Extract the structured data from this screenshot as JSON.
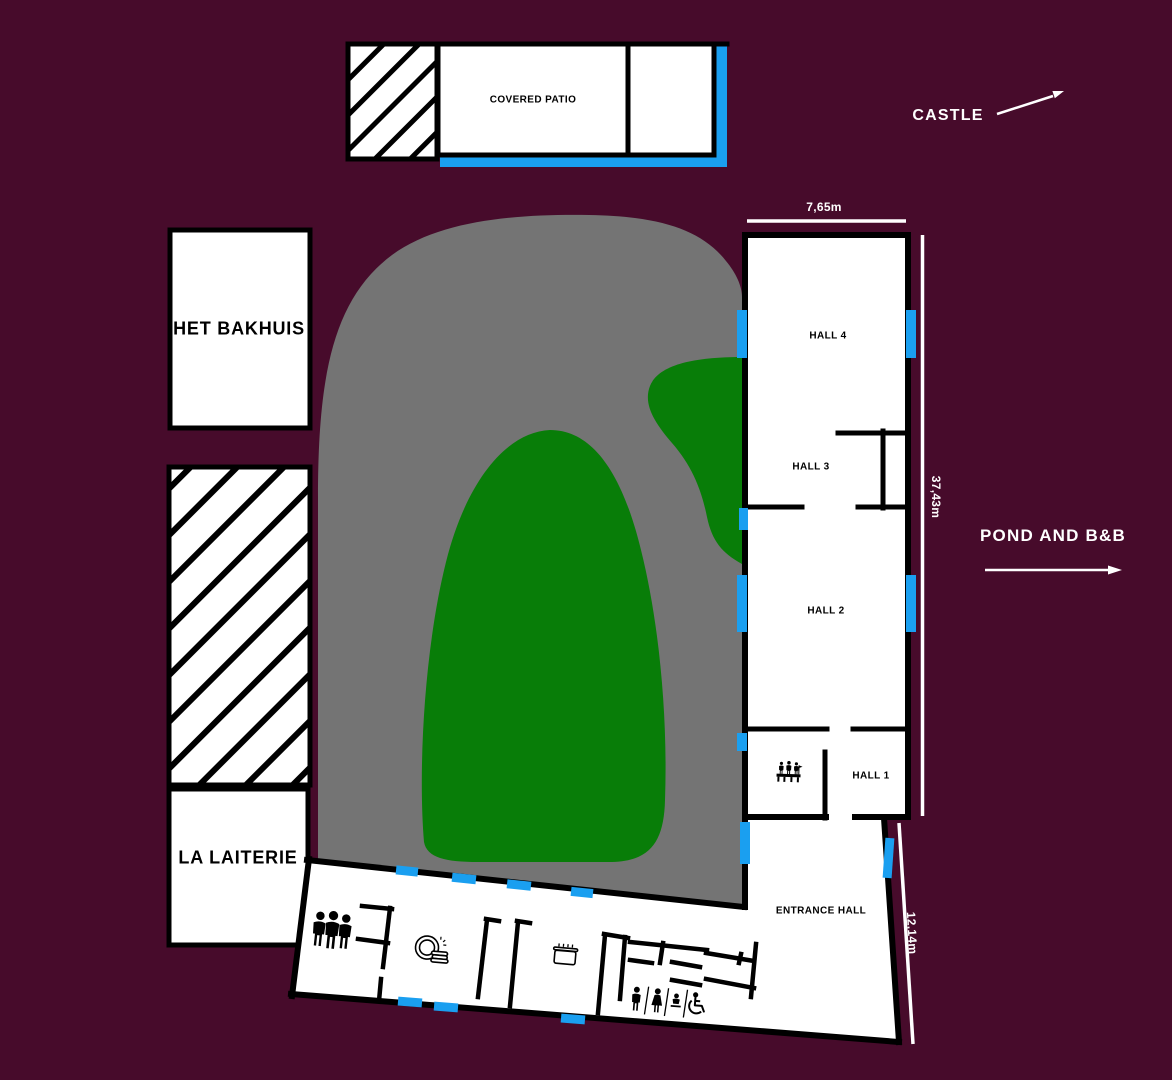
{
  "colors": {
    "background": "#470b2b",
    "courtyard": "#747474",
    "grass": "#087d08",
    "door": "#1a9ff0",
    "wall": "#000000",
    "room": "#ffffff",
    "label_light": "#ffffff"
  },
  "buildings": {
    "covered_patio": {
      "label": "COVERED PATIO"
    },
    "het_bakhuis": {
      "label": "HET BAKHUIS"
    },
    "la_laiterie": {
      "label": "LA LAITERIE"
    },
    "hall_4": {
      "label": "HALL 4"
    },
    "hall_3": {
      "label": "HALL 3"
    },
    "hall_2": {
      "label": "HALL 2"
    },
    "hall_1": {
      "label": "HALL 1"
    },
    "entrance_hall": {
      "label": "ENTRANCE HALL"
    }
  },
  "directions": {
    "castle": {
      "label": "CASTLE",
      "arrow": "up-right"
    },
    "pond_bnb": {
      "label": "POND AND B&B",
      "arrow": "right"
    }
  },
  "dimensions": {
    "hall_width": {
      "label": "7,65m"
    },
    "hall_length": {
      "label": "37,43m"
    },
    "entrance_length": {
      "label": "12,14m"
    }
  },
  "icons": {
    "visitor_group": "three-people-group",
    "dishwashing": "plate-with-dish-stack",
    "cooking_pot": "steaming-cooking-pot",
    "toilets": [
      "men",
      "women",
      "baby-change",
      "wheelchair-accessible"
    ],
    "reception": "people-at-reception-desk"
  }
}
